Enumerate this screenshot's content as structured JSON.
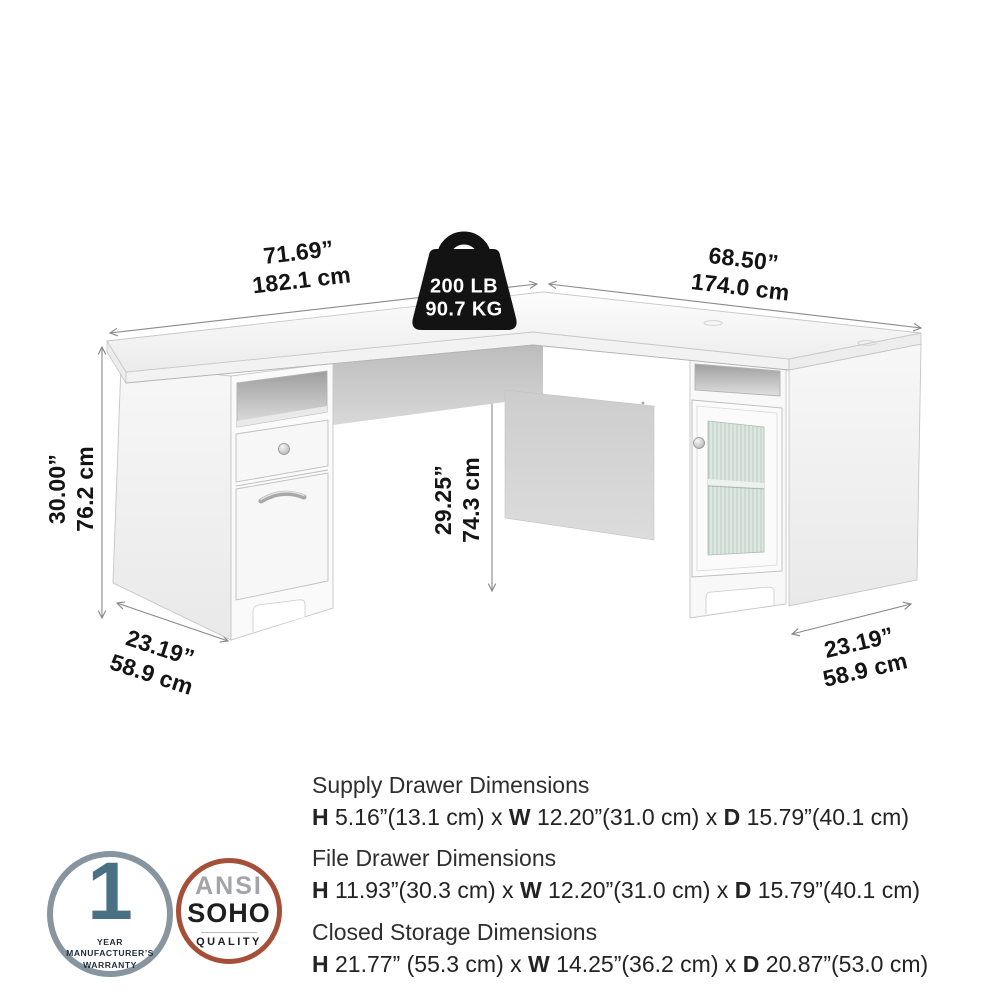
{
  "product_diagram": {
    "weight_capacity": {
      "icon": "weight-kettlebell",
      "line1": "200 LB",
      "line2": "90.7 KG"
    },
    "dimensions": {
      "desk_width_left": {
        "inches": "71.69”",
        "cm": "182.1 cm"
      },
      "desk_width_right": {
        "inches": "68.50”",
        "cm": "174.0 cm"
      },
      "desk_height": {
        "inches": "30.00”",
        "cm": "76.2 cm"
      },
      "knee_space_height": {
        "inches": "29.25”",
        "cm": "74.3 cm"
      },
      "depth_left": {
        "inches": "23.19”",
        "cm": "58.9 cm"
      },
      "depth_right": {
        "inches": "23.19”",
        "cm": "58.9 cm"
      }
    }
  },
  "spec_blocks": [
    {
      "title": "Supply Drawer Dimensions",
      "segments": [
        {
          "t": "H",
          "b": 1
        },
        {
          "t": " 5.16”(13.1 cm) x ",
          "b": 0
        },
        {
          "t": "W",
          "b": 1
        },
        {
          "t": " 12.20”(31.0 cm) x ",
          "b": 0
        },
        {
          "t": "D",
          "b": 1
        },
        {
          "t": " 15.79”(40.1 cm)",
          "b": 0
        }
      ]
    },
    {
      "title": "File Drawer Dimensions",
      "segments": [
        {
          "t": "H",
          "b": 1
        },
        {
          "t": " 11.93”(30.3 cm) x ",
          "b": 0
        },
        {
          "t": "W",
          "b": 1
        },
        {
          "t": " 12.20”(31.0 cm) x ",
          "b": 0
        },
        {
          "t": "D",
          "b": 1
        },
        {
          "t": " 15.79”(40.1 cm)",
          "b": 0
        }
      ]
    },
    {
      "title": "Closed Storage Dimensions",
      "segments": [
        {
          "t": "H",
          "b": 1
        },
        {
          "t": " 21.77” (55.3 cm) x ",
          "b": 0
        },
        {
          "t": "W",
          "b": 1
        },
        {
          "t": " 14.25”(36.2 cm) x ",
          "b": 0
        },
        {
          "t": "D",
          "b": 1
        },
        {
          "t": " 20.87”(53.0 cm)",
          "b": 0
        }
      ]
    }
  ],
  "badges": {
    "warranty": {
      "number": "1",
      "caption_line1": "YEAR MANUFACTURER’S",
      "caption_line2": "WARRANTY",
      "ring_color": "#8795a0",
      "number_color": "#4a7183",
      "text_color": "#1d2c3a"
    },
    "quality": {
      "line1": "ANSI",
      "line2": "SOHO",
      "line3": "QUALITY",
      "ring_color": "#a64f38",
      "line1_color": "#a2a4a7",
      "text_color": "#1e1e1e"
    }
  },
  "colors": {
    "background": "#ffffff",
    "dimension_text": "#141414",
    "dimension_line": "#8a8a8a",
    "weight_icon": "#131313"
  }
}
